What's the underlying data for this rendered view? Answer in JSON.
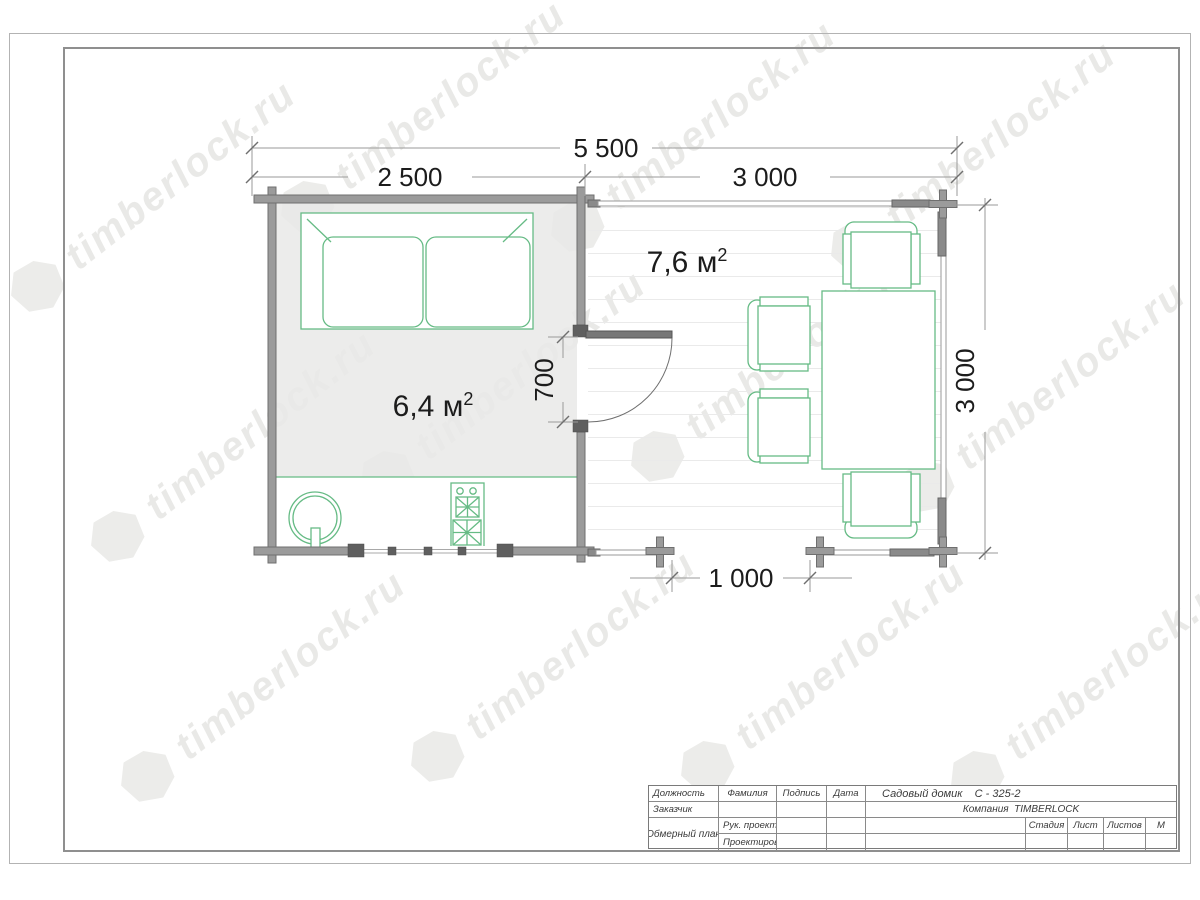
{
  "watermark": {
    "text": "timberlock.ru"
  },
  "plan": {
    "dim_total_width": "5 500",
    "dim_cabin_width": "2 500",
    "dim_terrace_width": "3 000",
    "dim_depth": "3 000",
    "dim_door": "700",
    "dim_entrance": "1 000",
    "cabin_area": "6,4 м",
    "cabin_area_sup": "2",
    "terrace_area": "7,6 м",
    "terrace_area_sup": "2"
  },
  "title_block": {
    "position_header": "Должность",
    "surname_header": "Фамилия",
    "signature_header": "Подпись",
    "date_header": "Дата",
    "project_title": "Садовый домик    С - 325-2",
    "customer_label": "Заказчик",
    "company": "Компания  TIMBERLOCK",
    "project_manager_label": "Рук. проекта",
    "designer_label": "Проектировщик",
    "drawing_name": "Обмерный план",
    "stage_header": "Стадия",
    "sheet_header": "Лист",
    "sheets_header": "Листов",
    "scale_header": "М"
  },
  "colors": {
    "furniture_green": "#66bb85",
    "wall_gray": "#9b9b9b",
    "watermark_gray": "#e9e9e7"
  }
}
